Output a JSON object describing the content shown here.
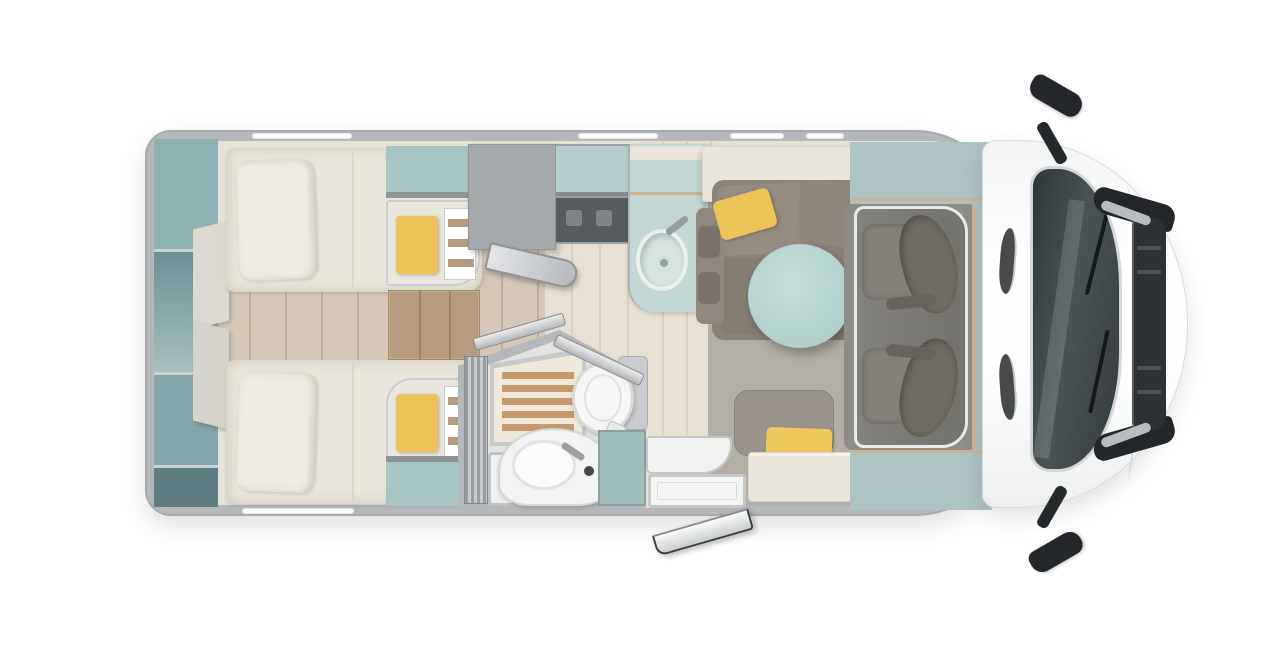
{
  "title": "motorhome-floorplan-top-view",
  "colors": {
    "bg": "#ffffff",
    "wall": "#b5b8bb",
    "base": "#e7e1d7",
    "wood": "#d5c8b9",
    "woodline": "#c0b09d",
    "woodlight": "#e7dfd2",
    "woodlightline": "#dacfc0",
    "rug": "#b3aea6",
    "teala": "#8fb3b3",
    "tealb": "#a9c4c4",
    "tealpale": "#c3d7d4",
    "tealband": "#aec3c4",
    "tealcabinet": "#9fbcbc",
    "table": "#b2d0cc",
    "mattress": "#eae5da",
    "pillow": "#f1ede4",
    "panel": "#dcd9d2",
    "yellow": "#ecc35a",
    "yellow2": "#eec85e",
    "woodshelf": "#b59c80",
    "wardrobe": "#a6a9ac",
    "counterdark": "#565b5e",
    "sofa": "#8a8177",
    "sofadark": "#7b7369",
    "benchback": "#9a948c",
    "cream": "#e9e5db",
    "bathfloor": "#e2e3e2",
    "slat": "#c49a6c",
    "white": "#f5f6f5",
    "chair": "#85817a",
    "chairdark": "#6f6b63",
    "trim": "#cdb392",
    "glass": "#343b3e",
    "black": "#23262a",
    "grille": "#2c3134"
  },
  "sections": {
    "vehicle": {
      "label": "motorhome top view floor plan"
    },
    "bedroom": {
      "label": "rear twin bedroom"
    },
    "bathroom": {
      "label": "bathroom with shower and toilet"
    },
    "kitchen": {
      "label": "kitchenette with sink and hob"
    },
    "dinette": {
      "label": "dinette lounge with round table"
    },
    "cab": {
      "label": "driver cab with two swivel seats"
    },
    "front": {
      "label": "vehicle front end with windshield and mirrors"
    }
  },
  "windows": {
    "top": [
      {
        "x": 252,
        "w": 100
      },
      {
        "x": 578,
        "w": 80
      },
      {
        "x": 730,
        "w": 54
      },
      {
        "x": 806,
        "w": 38
      }
    ],
    "bottom": [
      {
        "x": 242,
        "w": 112
      }
    ]
  }
}
